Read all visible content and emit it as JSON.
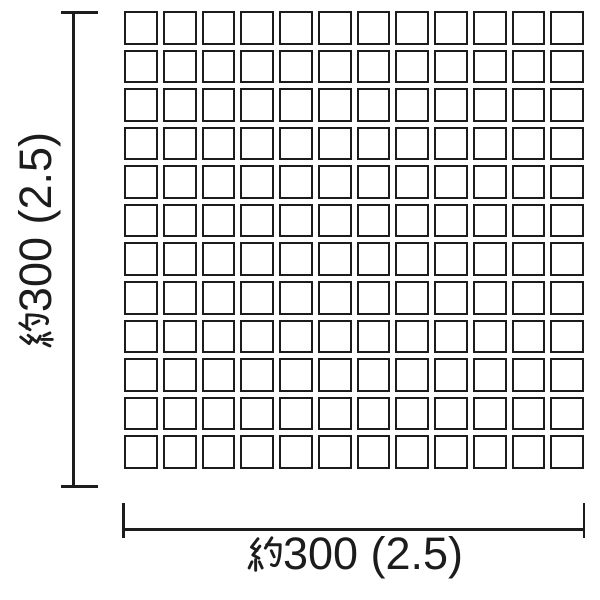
{
  "diagram": {
    "grid": {
      "rows": 12,
      "cols": 12
    },
    "vertical_dimension": {
      "label": "約300 (2.5)",
      "kanji_prefix": "約",
      "value": "300 (2.5)"
    },
    "horizontal_dimension": {
      "label": "約300 (2.5)",
      "kanji_prefix": "約",
      "value": "300 (2.5)"
    },
    "colors": {
      "line": "#1c1c1c",
      "background": "#ffffff",
      "tile_fill": "#ffffff"
    }
  }
}
